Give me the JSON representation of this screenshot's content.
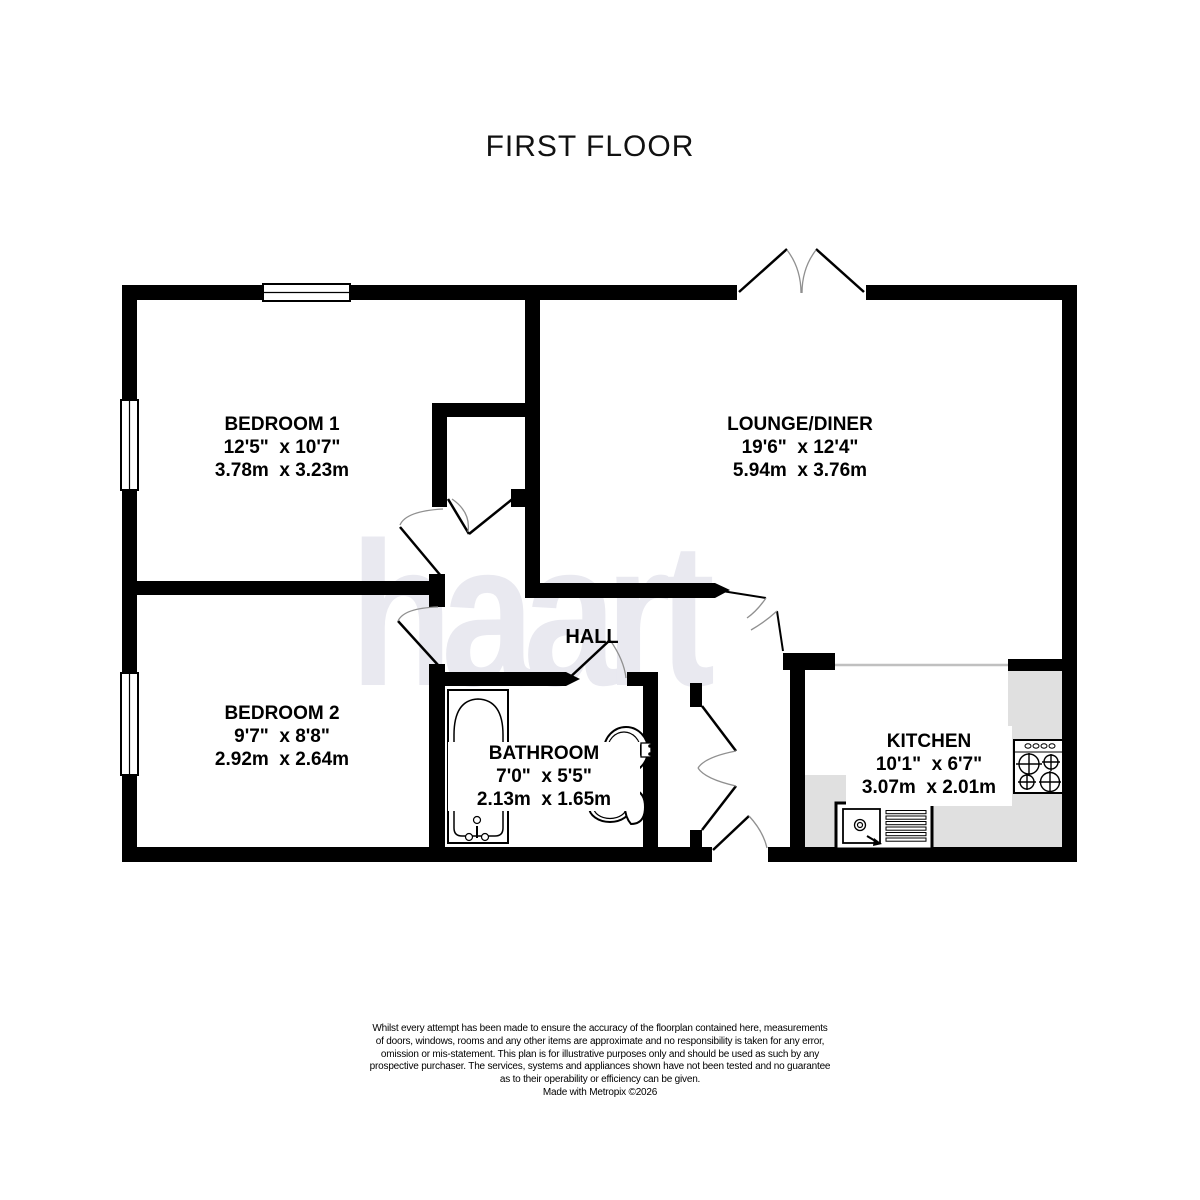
{
  "title": "FIRST FLOOR",
  "watermark": "haart",
  "rooms": {
    "bedroom1": {
      "name": "BEDROOM 1",
      "imperial": "12'5\"  x 10'7\"",
      "metric": "3.78m  x 3.23m"
    },
    "lounge": {
      "name": "LOUNGE/DINER",
      "imperial": "19'6\"  x 12'4\"",
      "metric": "5.94m  x 3.76m"
    },
    "bedroom2": {
      "name": "BEDROOM 2",
      "imperial": "9'7\"  x 8'8\"",
      "metric": "2.92m  x 2.64m"
    },
    "hall": {
      "name": "HALL"
    },
    "bathroom": {
      "name": "BATHROOM",
      "imperial": "7'0\"  x 5'5\"",
      "metric": "2.13m  x 1.65m"
    },
    "kitchen": {
      "name": "KITCHEN",
      "imperial": "10'1\"  x 6'7\"",
      "metric": "3.07m  x 2.01m"
    }
  },
  "disclaimer": {
    "line1": "Whilst every attempt has been made to ensure the accuracy of the floorplan contained here, measurements",
    "line2": "of doors, windows, rooms and any other items are approximate and no responsibility is taken for any error,",
    "line3": "omission or mis-statement. This plan is for illustrative purposes only and should be used as such by any",
    "line4": "prospective purchaser. The services, systems and appliances shown have not been tested and no guarantee",
    "line5": "as to their operability or efficiency can be given.",
    "credit": "Made with Metropix ©2026"
  },
  "colors": {
    "wall": "#000000",
    "counter": "#e0e0e0",
    "watermark": "#e9e9f0",
    "door_arc": "#909090",
    "open_plan_line": "#c0c0c0"
  }
}
